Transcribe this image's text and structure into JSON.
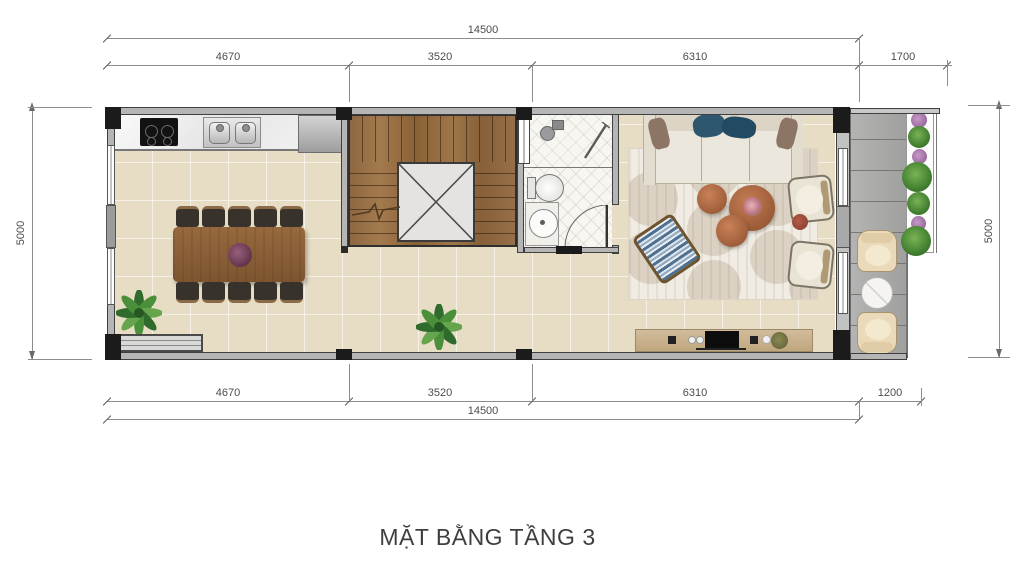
{
  "title": "MẶT BẰNG TẦNG 3",
  "dimensions": {
    "top": {
      "total": "14500",
      "segments": [
        "4670",
        "3520",
        "6310",
        "1700"
      ]
    },
    "bottom": {
      "total": "14500",
      "segments": [
        "4670",
        "3520",
        "6310",
        "1200"
      ]
    },
    "left": "5000",
    "right": "5000"
  },
  "colors": {
    "floor_tile": "#e7ddc4",
    "stair_wood": "#96704a",
    "balcony_tile": "#a9aaa8",
    "wall_fill": "#b5b5b5",
    "column": "#1b1b1b",
    "rug": "#f1ece3",
    "coffee_table": "#b06b47",
    "sofa_pillow_blue": "#2d566f",
    "plant_green": "#3f7d38",
    "dimension_text": "#4c4c4c"
  }
}
